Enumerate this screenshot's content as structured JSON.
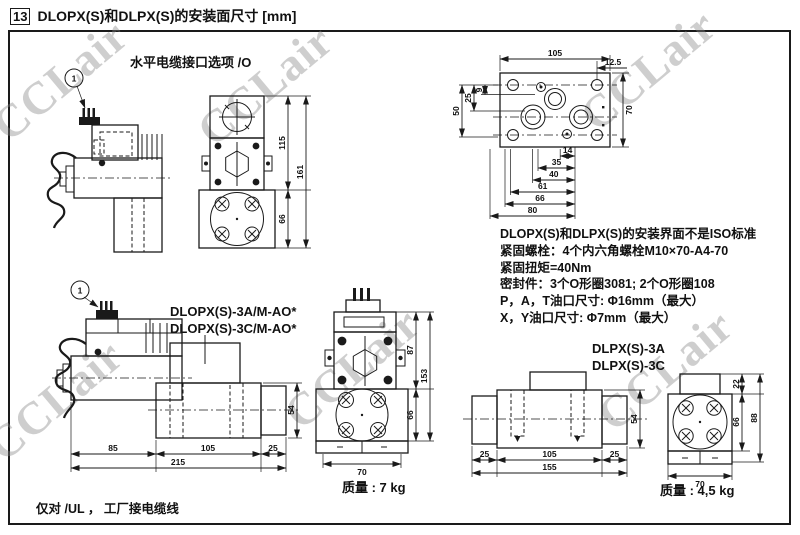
{
  "header": {
    "index": "13",
    "title": "DLOPX(S)和DLPX(S)的安装面尺寸 [mm]"
  },
  "watermark": "CCLair",
  "balloon": "1",
  "horizontal_cable_option": {
    "caption": "水平电缆接口选项 /O"
  },
  "dlopx_front_view": {
    "height_upper": "115",
    "height_total": "161",
    "height_flange": "66"
  },
  "mounting_face": {
    "width": "105",
    "offset": "12.5",
    "left_dims": [
      "9",
      "25",
      "50"
    ],
    "height": "70",
    "chain_dims": [
      "14",
      "35",
      "40",
      "61",
      "66",
      "80"
    ]
  },
  "notes": {
    "lines": [
      "DLOPX(S)和DLPX(S)的安装界面不是ISO标准",
      "紧固螺栓：4个内六角螺栓M10×70-A4-70",
      "紧固扭矩=40Nm",
      "密封件：3个O形圈3081; 2个O形圈108",
      "P，A，T油口尺寸: Φ16mm（最大）",
      "X，Y油口尺寸: Φ7mm（最大）"
    ]
  },
  "dlopx": {
    "model_labels": [
      "DLOPX(S)-3A/M-AO*",
      "DLOPX(S)-3C/M-AO*"
    ],
    "side_dims": [
      "85",
      "105",
      "25"
    ],
    "side_total": "215",
    "side_height": "54",
    "front_heights": [
      "87",
      "153",
      "66"
    ],
    "front_width": "70",
    "weight": "质量 : 7 kg"
  },
  "dlpx": {
    "model_labels": [
      "DLPX(S)-3A",
      "DLPX(S)-3C"
    ],
    "side_dims": [
      "25",
      "105",
      "25"
    ],
    "side_total": "155",
    "side_height": "54",
    "front_heights": [
      "22",
      "88",
      "66"
    ],
    "front_width": "70",
    "weight": "质量 : 4,5 kg"
  },
  "footer": {
    "note": "仅对 /UL ， 工厂接电缆线"
  }
}
